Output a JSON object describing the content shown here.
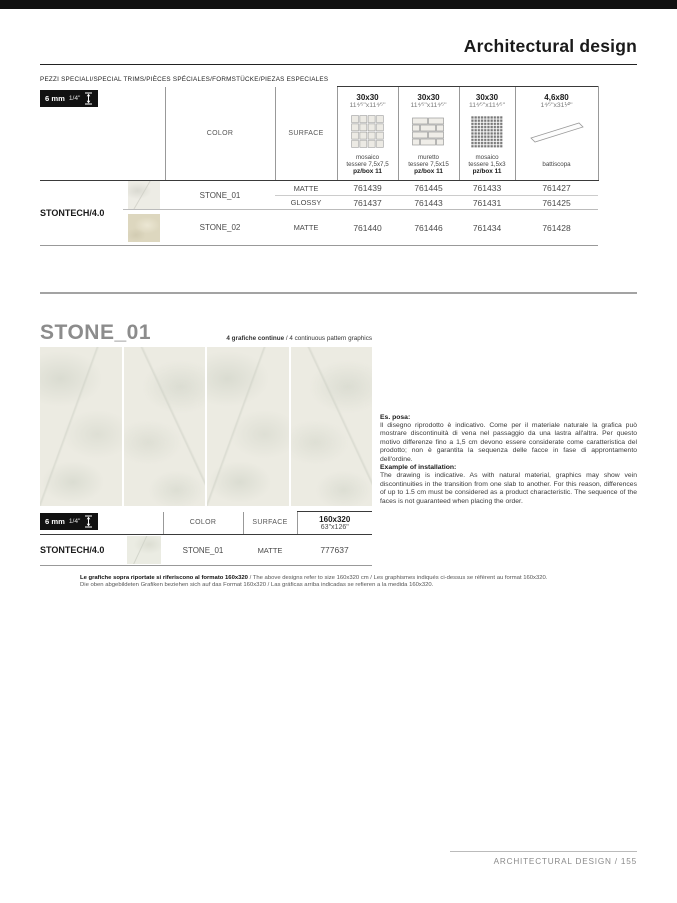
{
  "header": {
    "title": "Architectural design"
  },
  "trims": {
    "heading": "PEZZI SPECIALI/SPECIAL TRIMS/PIÈCES SPÉCIALES/FORMSTÜCKE/PIEZAS ESPECIALES",
    "badge": {
      "thickness": "6 mm",
      "inches": "1/4\""
    },
    "col_color": "COLOR",
    "col_surface": "SURFACE",
    "products": [
      {
        "size": "30x30",
        "size_in": "11⁴⁄⁵\"x11⁴⁄⁵\"",
        "icon": "mosaic-grid",
        "caption": "mosaico",
        "caption2": "tessere 7,5x7,5",
        "box": "pz/box 11"
      },
      {
        "size": "30x30",
        "size_in": "11⁴⁄⁵\"x11⁴⁄⁵\"",
        "icon": "muretto",
        "caption": "muretto",
        "caption2": "tessere 7,5x15",
        "box": "pz/box 11"
      },
      {
        "size": "30x30",
        "size_in": "11⁴⁄⁵\"x11⁴⁄⁵\"",
        "icon": "mosaic-dense",
        "caption": "mosaico",
        "caption2": "tessere 1,5x3",
        "box": "pz/box 11"
      },
      {
        "size": "4,6x80",
        "size_in": "1⁴⁄⁵\"x31¹⁄²\"",
        "icon": "battiscopa",
        "caption": "",
        "caption2": "battiscopa",
        "box": ""
      }
    ],
    "series": "STONTECH/4.0",
    "rows": [
      {
        "color": "STONE_01",
        "surface": "MATTE",
        "codes": [
          "761439",
          "761445",
          "761433",
          "761427"
        ]
      },
      {
        "surface": "GLOSSY",
        "codes": [
          "761437",
          "761443",
          "761431",
          "761425"
        ]
      },
      {
        "color": "STONE_02",
        "surface": "MATTE",
        "codes": [
          "761440",
          "761446",
          "761434",
          "761428"
        ]
      }
    ]
  },
  "stone": {
    "title": "STONE_01",
    "note_bold": "4 grafiche continue",
    "note_rest": " / 4 continuous pattern graphics",
    "installation": {
      "it_title": "Es. posa:",
      "it_body": "Il disegno riprodotto è indicativo. Come per il materiale naturale la grafica può mostrare discontinuità di vena nel passaggio da una lastra all'altra. Per questo motivo differenze fino a 1,5 cm devono essere considerate come caratteristica del prodotto; non è garantita la sequenza delle facce in fase di approntamento dell'ordine.",
      "en_title": "Example of installation:",
      "en_body": "The drawing is indicative. As with natural material, graphics may show vein discontinuities in the transition from one slab to another. For this reason, differences of up to 1.5 cm must be considered as a product characteristic. The sequence of the faces is not guaranteed when placing the order."
    },
    "table": {
      "badge": {
        "thickness": "6 mm",
        "inches": "1/4\""
      },
      "col_color": "COLOR",
      "col_surface": "SURFACE",
      "size": "160x320",
      "size_in": "63\"x126\"",
      "series": "STONTECH/4.0",
      "row": {
        "color": "STONE_01",
        "surface": "MATTE",
        "code": "777637"
      }
    },
    "footnote": {
      "bold": "Le grafiche sopra riportate si riferiscono al formato 160x320",
      "rest": " / The above designs refer to size 160x320 cm / Les graphismes indiqués ci-dessus se réfèrent au format 160x320.",
      "line2": "Die oben abgebildeten Grafiken beziehen sich auf das Format 160x320 / Las gráficas arriba indicadas se refieren a la medida 160x320."
    }
  },
  "footer": {
    "label": "ARCHITECTURAL DESIGN / 155"
  },
  "colors": {
    "accent_black": "#111111",
    "divider_gray": "#a3a3a3",
    "stone1_swatch": "#edece5",
    "stone2_swatch": "#ddd7bf",
    "tile_base": "#ecebe2"
  }
}
